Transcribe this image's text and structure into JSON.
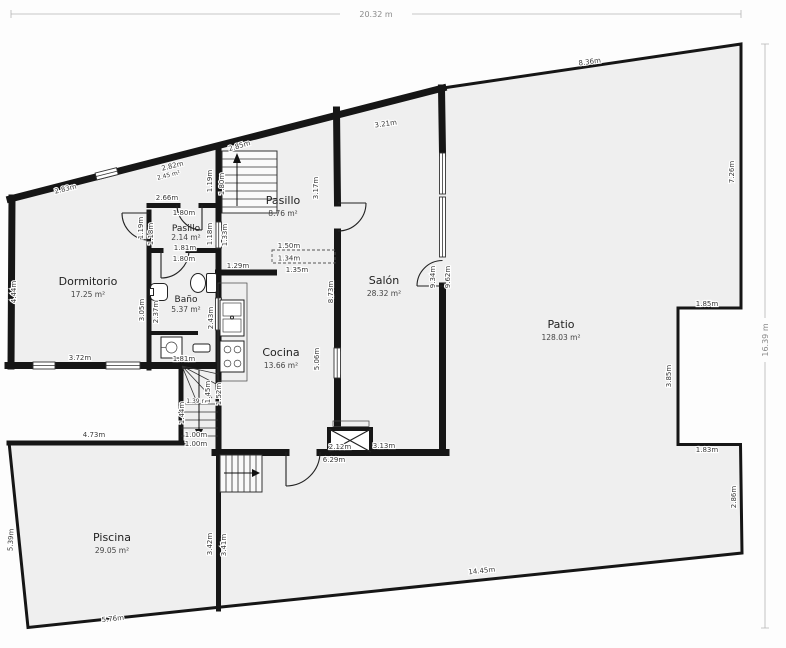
{
  "plan": {
    "overall_width": "20.32 m",
    "overall_height": "16.39 m",
    "rooms": {
      "dormitorio": {
        "name": "Dormitorio",
        "area": "17.25 m²"
      },
      "pasillo_small": {
        "name": "Pasillo",
        "area": "2.14 m²"
      },
      "bano": {
        "name": "Baño",
        "area": "5.37 m²"
      },
      "pasillo_large": {
        "name": "Pasillo",
        "area": "8.76 m²"
      },
      "cocina": {
        "name": "Cocina",
        "area": "13.66 m²"
      },
      "salon": {
        "name": "Salón",
        "area": "28.32 m²"
      },
      "patio": {
        "name": "Patio",
        "area": "128.03 m²"
      },
      "piscina": {
        "name": "Piscina",
        "area": "29.05 m²"
      },
      "storage": {
        "area": "2.45 m²"
      },
      "stairwell": {
        "area": "1.39 m²"
      }
    },
    "dims": {
      "dorm_top": "2.83m",
      "dorm_left": "4.44m",
      "dorm_bottom": "3.72m",
      "dorm_right": "3.05m",
      "storage_top": "2.82m",
      "storage_bottom": "2.66m",
      "p1_top": "1.80m",
      "p1_bottom": "1.81m",
      "p1_l1": "1.19m",
      "p1_l2": "1.18m",
      "p1_r1": "1.18m",
      "p1_r2": "1.33m",
      "st1_a": "1.19m",
      "st1_b": "1.80m",
      "p2_top": "2.85m",
      "p2_right": "3.17m",
      "salon_top": "3.21m",
      "salon_left": "8.73m",
      "salon_right_in": "9.34m",
      "salon_right_out": "9.62m",
      "salon_bottom": "3.13m",
      "salon_bottom_out": "6.29m",
      "bano_top": "1.80m",
      "bano_bottom": "1.81m",
      "bano_left": "2.37m",
      "bano_right": "2.43m",
      "k_top": "1.29m",
      "k_pass_a": "1.50m",
      "k_pass_b": "1.34m",
      "k_pass_c": "1.35m",
      "k_right": "5.06m",
      "k_left": "1.52m",
      "k_door": "2.12m",
      "st2_left": "1.44m",
      "st2_right": "1.45m",
      "st2_exit_a": "1.00m",
      "st2_exit_b": "1.00m",
      "patio_top": "8.36m",
      "patio_right": "7.26m",
      "notch_top": "1.85m",
      "notch_left": "3.85m",
      "notch_bottom": "1.83m",
      "patio_right2": "2.86m",
      "patio_bottom": "14.45m",
      "pool_bottom": "5.76m",
      "pool_left": "5.39m",
      "pool_top": "4.73m",
      "div_left": "3.42m",
      "div_right": "3.41m"
    }
  }
}
